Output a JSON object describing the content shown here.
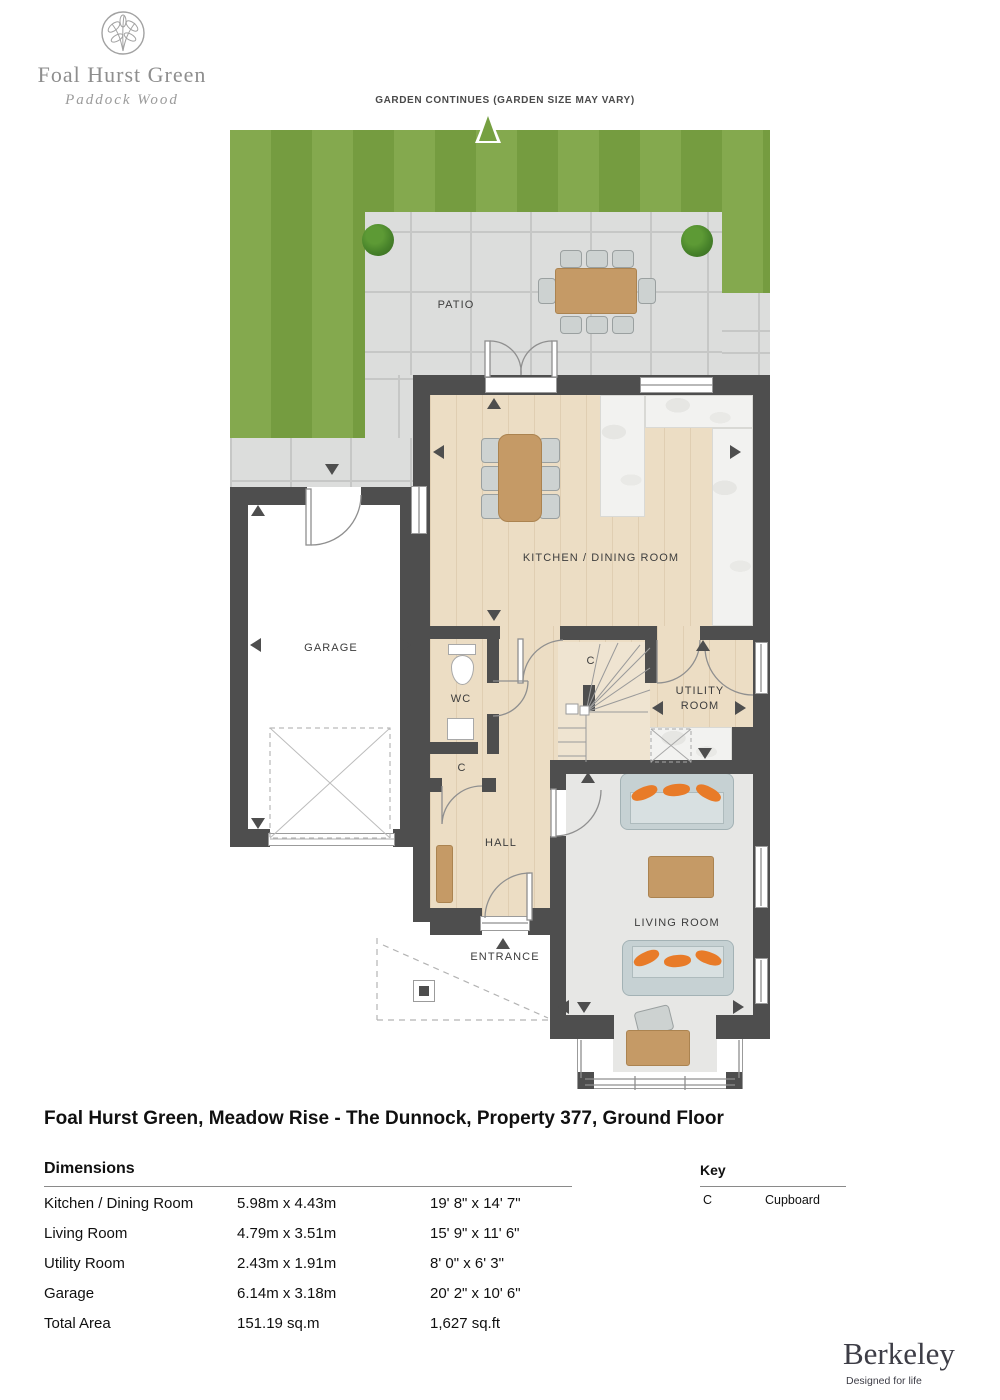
{
  "branding": {
    "development_name": "Foal Hurst Green",
    "development_location": "Paddock Wood",
    "builder_name": "Berkeley",
    "builder_tagline": "Designed for life"
  },
  "garden_note": "GARDEN CONTINUES (GARDEN SIZE MAY VARY)",
  "plan_labels": {
    "patio": "PATIO",
    "kitchen_dining": "KITCHEN / DINING ROOM",
    "garage": "GARAGE",
    "wc": "WC",
    "cupboard_stairs": "C",
    "cupboard_hall": "C",
    "utility_line1": "UTILITY",
    "utility_line2": "ROOM",
    "hall": "HALL",
    "living_room": "LIVING ROOM",
    "entrance": "ENTRANCE"
  },
  "title": "Foal Hurst Green, Meadow Rise - The Dunnock, Property 377, Ground Floor",
  "dimensions": {
    "heading": "Dimensions",
    "rows": [
      {
        "room": "Kitchen / Dining Room",
        "metric": "5.98m x 4.43m",
        "imperial": "19' 8\" x 14' 7\""
      },
      {
        "room": "Living Room",
        "metric": "4.79m x 3.51m",
        "imperial": "15' 9\" x 11' 6\""
      },
      {
        "room": "Utility Room",
        "metric": "2.43m x 1.91m",
        "imperial": "8' 0\" x 6' 3\""
      },
      {
        "room": "Garage",
        "metric": "6.14m x 3.18m",
        "imperial": "20' 2\" x 10' 6\""
      },
      {
        "room": "Total Area",
        "metric": "151.19 sq.m",
        "imperial": "1,627 sq.ft"
      }
    ]
  },
  "key": {
    "heading": "Key",
    "symbol": "C",
    "symbol_label": "Cupboard"
  },
  "colors": {
    "wall": "#4e4e4e",
    "grass_light": "#84a94e",
    "grass_dark": "#759c40",
    "accent_orange": "#e87b28",
    "wood_floor": "#ecddc4",
    "logo_grey": "#8e8e8e"
  }
}
